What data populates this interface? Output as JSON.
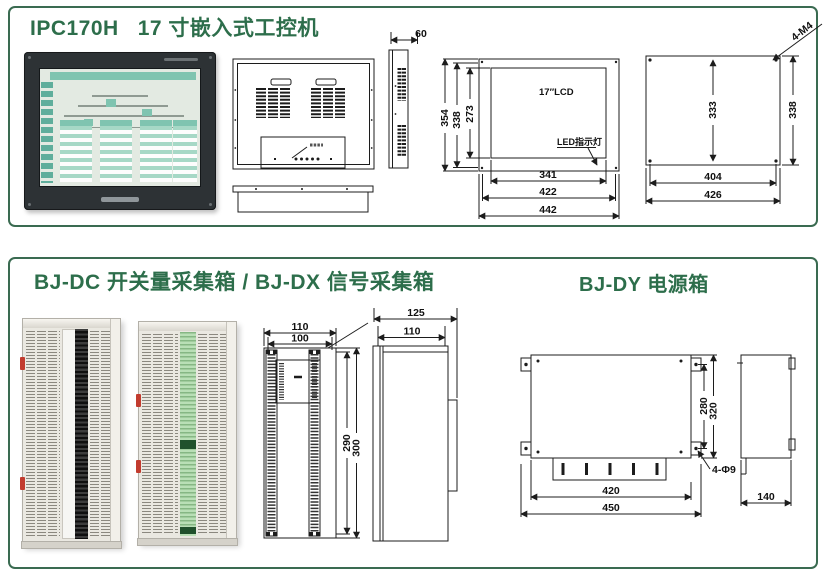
{
  "colors": {
    "title_green": "#2d6e4b",
    "panel_border_green": "#3a6b51",
    "drawing_line": "#1c1c1c"
  },
  "section_ipc": {
    "title": "IPC170H   17 寸嵌入式工控机",
    "side_view": {
      "depth_dim": "60"
    },
    "front_view": {
      "lcd_label": "17″LCD",
      "led_label": "LED指示灯",
      "height_outer": "354",
      "height_mid": "338",
      "height_lcd": "273",
      "width_lcd": "341",
      "width_mid": "422",
      "width_outer": "442"
    },
    "cutout_view": {
      "screw_label": "4-M4",
      "height_inner": "333",
      "height_outer": "338",
      "width_inner": "404",
      "width_outer": "426"
    }
  },
  "section_bj": {
    "title": "BJ-DC 开关量采集箱 / BJ-DX 信号采集箱",
    "title_dy": "BJ-DY 电源箱",
    "box_views": {
      "width_outer": "110",
      "width_inner": "100",
      "height_inner": "290",
      "height_outer": "300",
      "depth_outer": "125",
      "depth_inner": "110"
    },
    "dy_views": {
      "height_inner": "280",
      "height_outer": "320",
      "hole_label": "4-Φ9",
      "width_inner": "420",
      "width_outer": "450",
      "depth": "140"
    }
  }
}
